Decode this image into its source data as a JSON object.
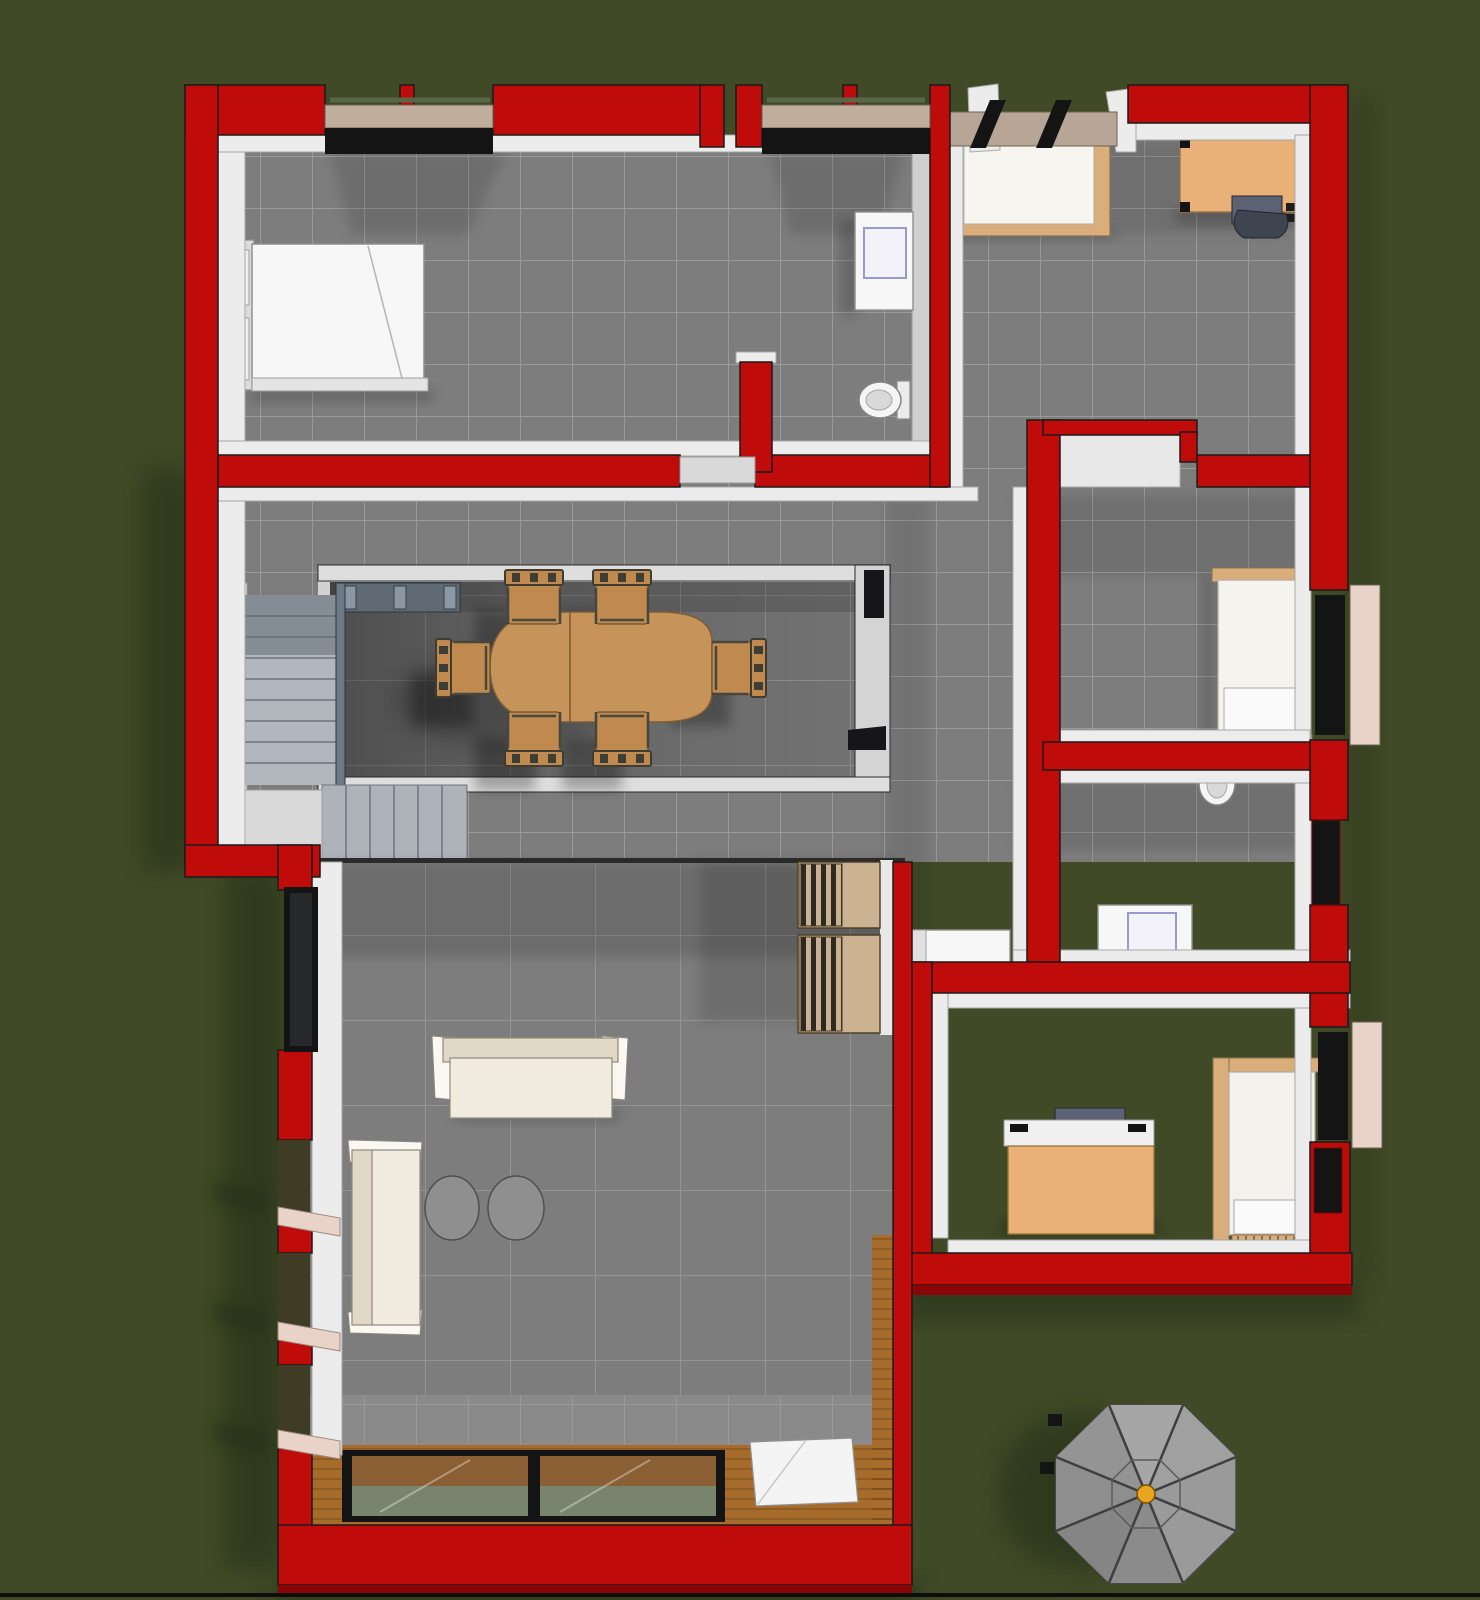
{
  "scene": {
    "type": "3d-floor-plan-rendering",
    "view": "top-down",
    "rooms": [
      {
        "name": "bedroom-northwest",
        "floor": "gray-tile"
      },
      {
        "name": "bathroom-nook-north",
        "floor": "gray-tile"
      },
      {
        "name": "bedroom-northeast",
        "floor": "gray-tile"
      },
      {
        "name": "hallway-with-stair-void",
        "floor": "gray-tile"
      },
      {
        "name": "dining-void-lower-level",
        "floor": "gray-tile-large"
      },
      {
        "name": "corridor-east",
        "floor": "gray-tile"
      },
      {
        "name": "bedroom-east-middle",
        "floor": "gray-tile"
      },
      {
        "name": "bathroom-east",
        "floor": "gray-tile"
      },
      {
        "name": "study-bedroom-southeast",
        "floor": "gray-tile"
      },
      {
        "name": "living-room-southwest",
        "floor": "gray-tile-large"
      },
      {
        "name": "balcony-south",
        "floor": "wood-plank"
      }
    ],
    "furniture": [
      "double-bed",
      "washbasin-cabinet",
      "toilet",
      "single-bed-northeast",
      "computer-desk-northeast",
      "office-chair",
      "dining-table",
      "dining-chair-x6",
      "l-shaped-staircase",
      "stair-railing",
      "single-bed-east",
      "toilet-east",
      "washing-machine",
      "sideboard-cabinet",
      "computer-desk-southeast",
      "single-bed-southeast",
      "sofa-large",
      "sofa-small",
      "round-table-x2",
      "bookshelf-x2",
      "sliding-glass-door",
      "door-mat",
      "patio-umbrella"
    ],
    "umbrella": {
      "shape": "octagon",
      "ribs": 8,
      "hub_color": "#e8a51f"
    }
  },
  "colors": {
    "background": "#404a27",
    "ground_shadow": "#242e12",
    "wall_red": "#c00b0b",
    "wall_red_dark": "#8a0505",
    "wall_white": "#ececec",
    "floor_gray": "#7d7d7d",
    "void_floor": "#727272",
    "wood": "#a76c2b",
    "table_tan": "#c6935a",
    "chair_tan": "#c08a4e",
    "desk_tan": "#e9b077",
    "bed_rim_tan": "#d9ae7b",
    "sofa_cream": "#f2ebdf",
    "white_furniture": "#f7f7f7",
    "frame_black": "#141414",
    "glass_green": "#78846e",
    "glass_brown": "#8a5f33",
    "sill_tan": "#bfae9c",
    "sill_pink": "#e9d2c8",
    "stair_gray": "#b2b7bd",
    "rail_blue": "#6e7a86",
    "umbrella_gray": "#9a9a9a",
    "umbrella_hub": "#e8a51f",
    "computer_dark": "#5a6273",
    "fixture_blue": "#9a9ad2"
  }
}
